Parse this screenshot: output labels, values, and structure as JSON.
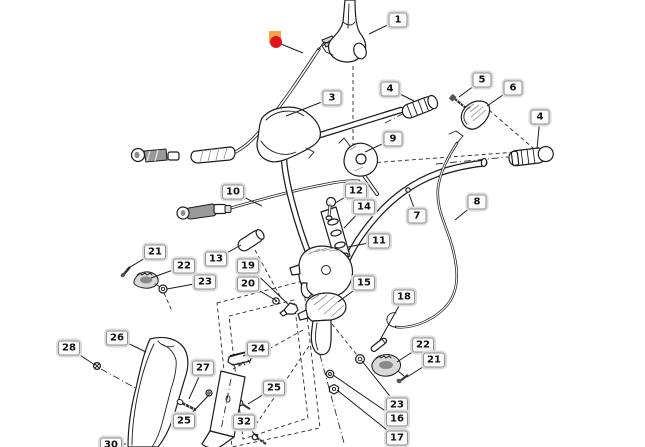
{
  "diagram": {
    "kind": "exploded-parts-diagram",
    "description": "Line-art exploded view of a mower handlebar assembly with control cables, grips, levers, covers and fasteners, annotated with numbered callout balloons.",
    "background_color": "#ffffff",
    "line_color": "#1c1c1c",
    "callout_style": {
      "background": "#fcfcfc",
      "border": "#8f8f8f",
      "outer_ring": "#dcdcdc",
      "text_color": "#111111"
    },
    "highlight_marker": {
      "meaning": "selected-part-indicator on cable",
      "dot_color": "#e3151c",
      "square_color": "#f3a64c",
      "x": 276,
      "y": 42,
      "square": {
        "x": 269,
        "y": 31,
        "size": 12
      },
      "leader_to": {
        "x": 303,
        "y": 53
      }
    },
    "callouts": [
      {
        "label": "1",
        "x": 398,
        "y": 20,
        "tx": 369,
        "ty": 34
      },
      {
        "label": "3",
        "x": 332,
        "y": 98,
        "tx": 286,
        "ty": 116
      },
      {
        "label": "4",
        "x": 390,
        "y": 89,
        "tx": 414,
        "ty": 101
      },
      {
        "label": "5",
        "x": 482,
        "y": 80,
        "tx": 459,
        "ty": 97
      },
      {
        "label": "6",
        "x": 513,
        "y": 88,
        "tx": 487,
        "ty": 106
      },
      {
        "label": "4",
        "x": 540,
        "y": 117,
        "tx": 537,
        "ty": 149
      },
      {
        "label": "9",
        "x": 393,
        "y": 139,
        "tx": 365,
        "ty": 152
      },
      {
        "label": "10",
        "x": 233,
        "y": 192,
        "tx": 262,
        "ty": 206
      },
      {
        "label": "12",
        "x": 356,
        "y": 191,
        "tx": 335,
        "ty": 203
      },
      {
        "label": "14",
        "x": 364,
        "y": 207,
        "tx": 344,
        "ty": 228
      },
      {
        "label": "7",
        "x": 417,
        "y": 216,
        "tx": 409,
        "ty": 194
      },
      {
        "label": "8",
        "x": 477,
        "y": 202,
        "tx": 455,
        "ty": 220
      },
      {
        "label": "11",
        "x": 379,
        "y": 241,
        "tx": 348,
        "ty": 247
      },
      {
        "label": "13",
        "x": 216,
        "y": 259,
        "tx": 241,
        "ty": 245
      },
      {
        "label": "19",
        "x": 248,
        "y": 266,
        "tx": 289,
        "ty": 305
      },
      {
        "label": "20",
        "x": 248,
        "y": 284,
        "tx": 277,
        "ty": 301
      },
      {
        "label": "21",
        "x": 155,
        "y": 252,
        "tx": 127,
        "ty": 269
      },
      {
        "label": "22",
        "x": 184,
        "y": 266,
        "tx": 151,
        "ty": 278
      },
      {
        "label": "23",
        "x": 205,
        "y": 282,
        "tx": 167,
        "ty": 289
      },
      {
        "label": "15",
        "x": 364,
        "y": 283,
        "tx": 338,
        "ty": 302
      },
      {
        "label": "18",
        "x": 404,
        "y": 297,
        "tx": 380,
        "ty": 340
      },
      {
        "label": "22",
        "x": 423,
        "y": 345,
        "tx": 397,
        "ty": 362
      },
      {
        "label": "21",
        "x": 434,
        "y": 360,
        "tx": 407,
        "ty": 377
      },
      {
        "label": "23",
        "x": 397,
        "y": 405,
        "tx": 362,
        "ty": 361
      },
      {
        "label": "16",
        "x": 397,
        "y": 419,
        "tx": 333,
        "ty": 375
      },
      {
        "label": "17",
        "x": 397,
        "y": 438,
        "tx": 337,
        "ty": 390
      },
      {
        "label": "26",
        "x": 117,
        "y": 338,
        "tx": 146,
        "ty": 352
      },
      {
        "label": "28",
        "x": 69,
        "y": 348,
        "tx": 95,
        "ty": 365
      },
      {
        "label": "27",
        "x": 203,
        "y": 368,
        "tx": 189,
        "ty": 399
      },
      {
        "label": "24",
        "x": 258,
        "y": 349,
        "tx": 243,
        "ty": 356
      },
      {
        "label": "25",
        "x": 274,
        "y": 388,
        "tx": 248,
        "ty": 404
      },
      {
        "label": "25",
        "x": 184,
        "y": 421,
        "tx": 209,
        "ty": 395
      },
      {
        "label": "32",
        "x": 244,
        "y": 422,
        "tx": 257,
        "ty": 437
      },
      {
        "label": "30",
        "x": 111,
        "y": 445,
        "tx": 126,
        "ty": 444
      }
    ]
  }
}
